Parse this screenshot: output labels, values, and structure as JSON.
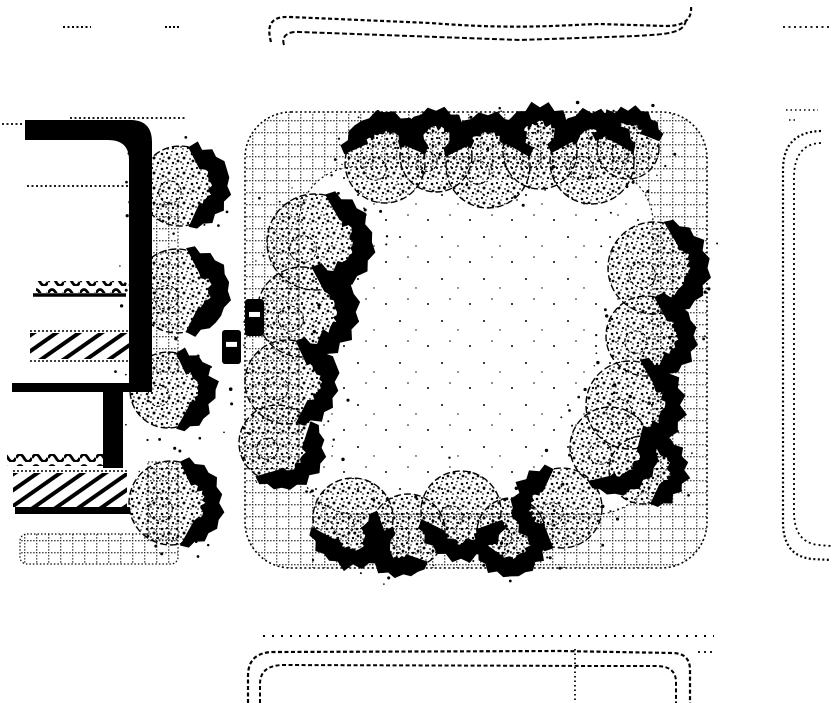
{
  "meta": {
    "title": "Plaza site plan",
    "description": "Scanned black-and-white landscape architecture site plan: a square plaza with rounded corners, grid paving band, perimeter shade trees with dark shadow fringes, flanking street block with crosswalks and walls on the left, and dotted curb lines of neighboring blocks above, right and below",
    "ink": "#000000",
    "paper": "#ffffff"
  },
  "plan": {
    "plaza": {
      "outer": {
        "x": 245,
        "y": 112,
        "width": 462,
        "height": 456,
        "radius": 46
      },
      "inner": {
        "x": 299,
        "y": 167,
        "width": 354,
        "height": 347,
        "radius": 56
      }
    },
    "trees": [
      {
        "x": 180,
        "y": 186,
        "r": 40,
        "shadow": "E"
      },
      {
        "x": 177,
        "y": 291,
        "r": 42,
        "shadow": "E"
      },
      {
        "x": 168,
        "y": 390,
        "r": 38,
        "shadow": "E"
      },
      {
        "x": 171,
        "y": 503,
        "r": 42,
        "shadow": "E"
      },
      {
        "x": 385,
        "y": 163,
        "r": 40,
        "shadow": "N"
      },
      {
        "x": 436,
        "y": 156,
        "r": 36,
        "shadow": "N"
      },
      {
        "x": 488,
        "y": 166,
        "r": 42,
        "shadow": "N"
      },
      {
        "x": 540,
        "y": 152,
        "r": 37,
        "shadow": "N"
      },
      {
        "x": 592,
        "y": 162,
        "r": 42,
        "shadow": "N"
      },
      {
        "x": 628,
        "y": 148,
        "r": 31,
        "shadow": "N"
      },
      {
        "x": 315,
        "y": 242,
        "r": 48,
        "shadow": "E"
      },
      {
        "x": 302,
        "y": 312,
        "r": 45,
        "shadow": "E"
      },
      {
        "x": 287,
        "y": 382,
        "r": 42,
        "shadow": "E"
      },
      {
        "x": 277,
        "y": 443,
        "r": 38,
        "shadow": "SE"
      },
      {
        "x": 353,
        "y": 518,
        "r": 40,
        "shadow": "S"
      },
      {
        "x": 408,
        "y": 531,
        "r": 37,
        "shadow": "SW"
      },
      {
        "x": 461,
        "y": 511,
        "r": 40,
        "shadow": "S"
      },
      {
        "x": 511,
        "y": 532,
        "r": 34,
        "shadow": "S"
      },
      {
        "x": 562,
        "y": 508,
        "r": 40,
        "shadow": "W"
      },
      {
        "x": 654,
        "y": 268,
        "r": 46,
        "shadow": "E"
      },
      {
        "x": 646,
        "y": 336,
        "r": 40,
        "shadow": "E"
      },
      {
        "x": 630,
        "y": 405,
        "r": 44,
        "shadow": "E"
      },
      {
        "x": 610,
        "y": 447,
        "r": 40,
        "shadow": "SE"
      },
      {
        "x": 643,
        "y": 470,
        "r": 34,
        "shadow": "E"
      }
    ],
    "bollards": [
      {
        "x": 245,
        "y": 299,
        "w": 19,
        "h": 37
      },
      {
        "x": 222,
        "y": 330,
        "w": 19,
        "h": 34
      }
    ]
  }
}
